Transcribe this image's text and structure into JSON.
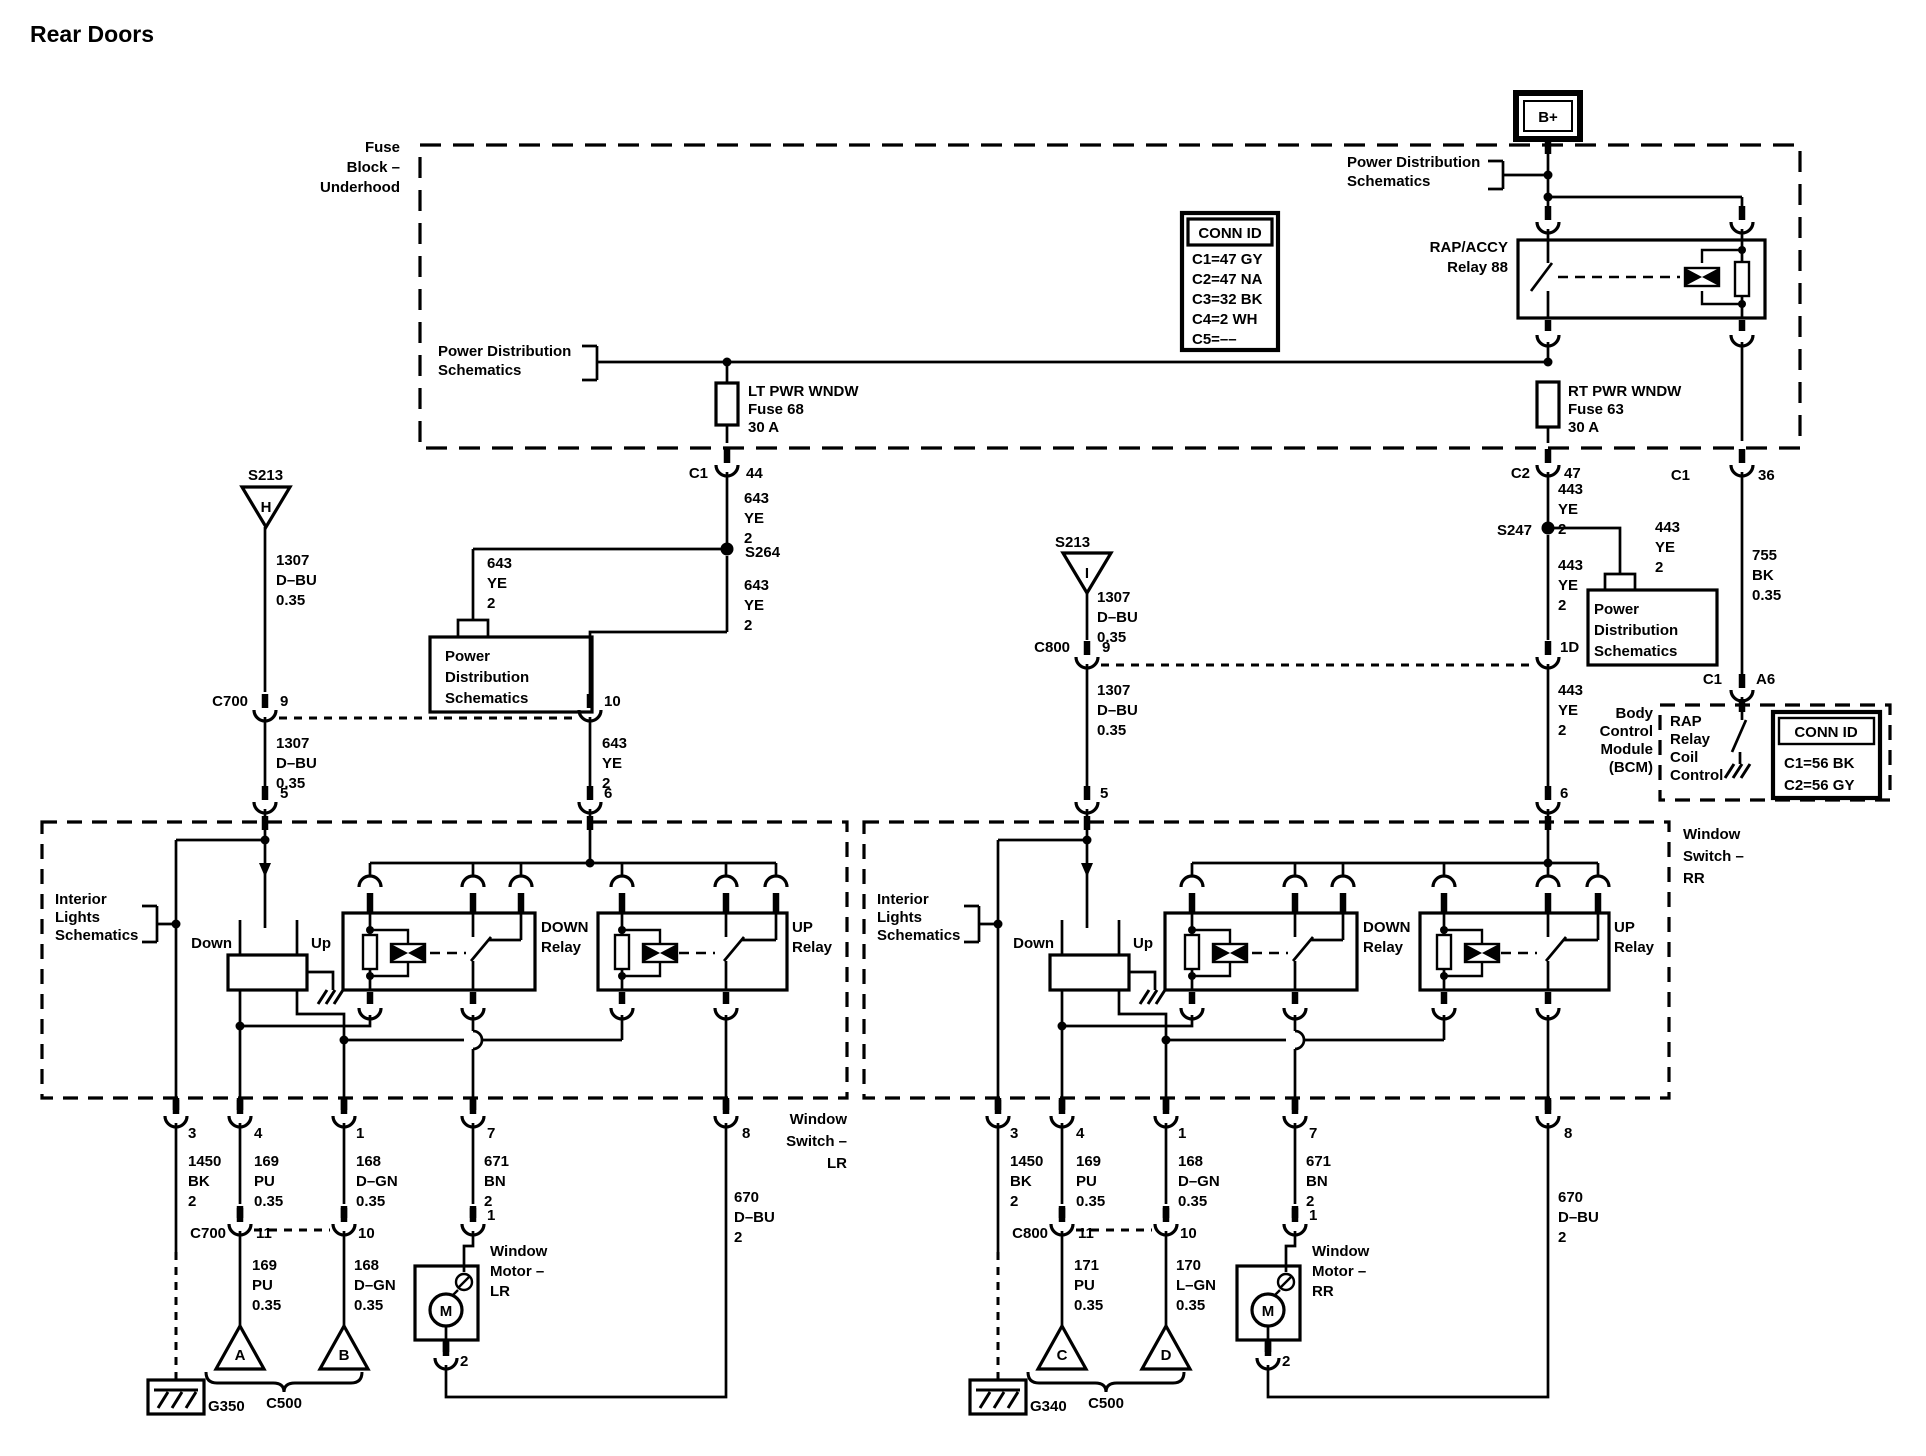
{
  "title": "Rear Doors",
  "fuse_block": {
    "label": [
      "Fuse",
      "Block –",
      "Underhood"
    ],
    "battery": "B+",
    "relay": [
      "RAP/ACCY",
      "Relay 88"
    ],
    "lt_fuse": [
      "LT PWR WNDW",
      "Fuse 68",
      "30 A"
    ],
    "rt_fuse": [
      "RT PWR WNDW",
      "Fuse 63",
      "30 A"
    ]
  },
  "conn_id_underhood": {
    "header": "CONN ID",
    "rows": [
      "C1=47 GY",
      "C2=47 NA",
      "C3=32 BK",
      "C4=2 WH",
      "C5=––"
    ]
  },
  "bcm": {
    "label": [
      "Body",
      "Control",
      "Module",
      "(BCM)"
    ],
    "func": [
      "RAP",
      "Relay",
      "Coil",
      "Control"
    ],
    "conn_id": {
      "header": "CONN ID",
      "rows": [
        "C1=56 BK",
        "C2=56 GY"
      ]
    }
  },
  "refs": {
    "pds_inline": [
      "Power Distribution",
      "Schematics"
    ],
    "pds_box": [
      "Power",
      "Distribution",
      "Schematics"
    ],
    "interior": [
      "Interior",
      "Lights",
      "Schematics"
    ]
  },
  "wires": {
    "w1307": [
      "1307",
      "D–BU",
      "0.35"
    ],
    "w643": [
      "643",
      "YE",
      "2"
    ],
    "w443": [
      "443",
      "YE",
      "2"
    ],
    "w755": [
      "755",
      "BK",
      "0.35"
    ],
    "w1450": [
      "1450",
      "BK",
      "2"
    ],
    "w169": [
      "169",
      "PU",
      "0.35"
    ],
    "w168": [
      "168",
      "D–GN",
      "0.35"
    ],
    "w171": [
      "171",
      "PU",
      "0.35"
    ],
    "w170": [
      "170",
      "L–GN",
      "0.35"
    ],
    "w671": [
      "671",
      "BN",
      "2"
    ],
    "w670": [
      "670",
      "D–BU",
      "2"
    ]
  },
  "pins": {
    "p1": "1",
    "p2": "2",
    "p3": "3",
    "p4": "4",
    "p5": "5",
    "p6": "6",
    "p7": "7",
    "p8": "8",
    "p9": "9",
    "p10": "10",
    "p11": "11",
    "p44": "44",
    "p47": "47",
    "p36": "36",
    "pa6": "A6",
    "p1d": "1D"
  },
  "splices": {
    "s213": "S213",
    "s264": "S264",
    "s247": "S247"
  },
  "connectors": {
    "c1": "C1",
    "c2": "C2",
    "c700": "C700",
    "c800": "C800",
    "c500": "C500"
  },
  "grounds": {
    "g350": "G350",
    "g340": "G340"
  },
  "switch": {
    "lr_name": [
      "Window",
      "Switch –",
      "LR"
    ],
    "rr_name": [
      "Window",
      "Switch –",
      "RR"
    ],
    "down": "Down",
    "up": "Up",
    "down_relay": [
      "DOWN",
      "Relay"
    ],
    "up_relay": [
      "UP",
      "Relay"
    ]
  },
  "motor": {
    "lr": [
      "Window",
      "Motor –",
      "LR"
    ],
    "rr": [
      "Window",
      "Motor –",
      "RR"
    ],
    "m": "M"
  },
  "tri": {
    "h": "H",
    "i": "I",
    "a": "A",
    "b": "B",
    "c": "C",
    "d": "D"
  }
}
